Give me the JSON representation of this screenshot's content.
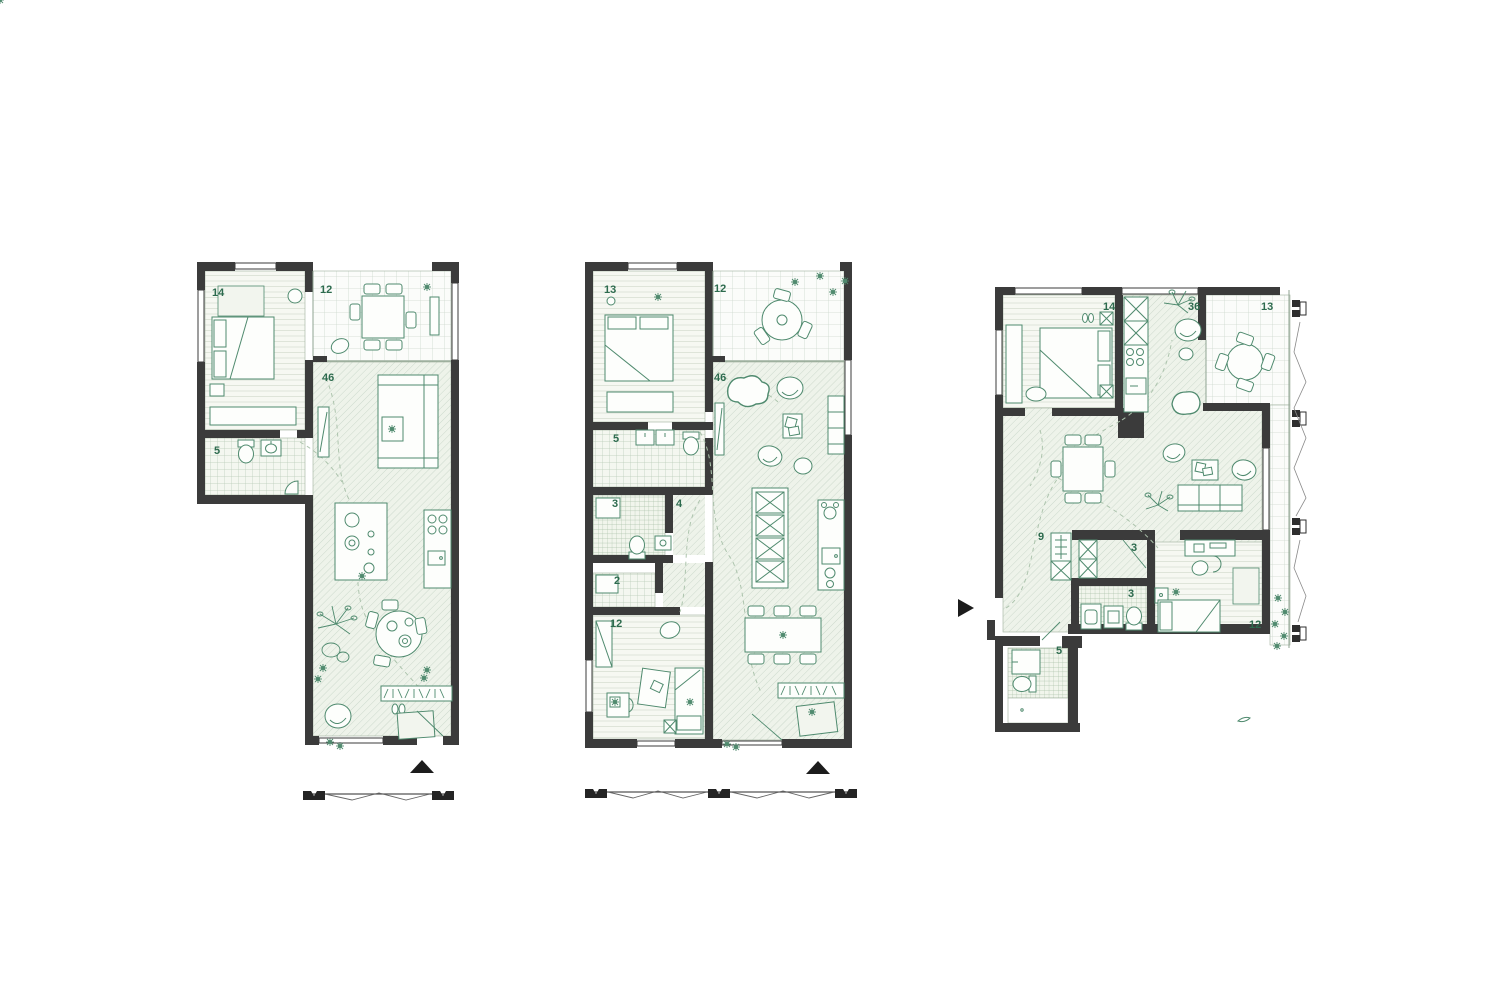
{
  "colors": {
    "wall": "#3b3b3b",
    "furniture_line": "#4f8a6e",
    "label_text": "#2d6b4e",
    "hatch_living": "#c9d6c9",
    "hatch_tile": "#aec4ad",
    "hatch_terrace": "#cdd8cd",
    "hatch_plank": "#d8e0d3"
  },
  "plans": [
    {
      "name": "left-floor-plan",
      "rooms": [
        {
          "number": "14"
        },
        {
          "number": "12"
        },
        {
          "number": "46"
        },
        {
          "number": "5"
        }
      ]
    },
    {
      "name": "middle-floor-plan",
      "rooms": [
        {
          "number": "13"
        },
        {
          "number": "12"
        },
        {
          "number": "46"
        },
        {
          "number": "5"
        },
        {
          "number": "3"
        },
        {
          "number": "4"
        },
        {
          "number": "2"
        },
        {
          "number": "12"
        }
      ]
    },
    {
      "name": "right-floor-plan",
      "rooms": [
        {
          "number": "14"
        },
        {
          "number": "36"
        },
        {
          "number": "13"
        },
        {
          "number": "9"
        },
        {
          "number": "3"
        },
        {
          "number": "3"
        },
        {
          "number": "12"
        },
        {
          "number": "5"
        }
      ]
    }
  ],
  "icons": {
    "north_arrow": "▲",
    "entry_arrow": "▶",
    "section_marker": "section-flag",
    "balcony_bracket": "support-clip"
  }
}
